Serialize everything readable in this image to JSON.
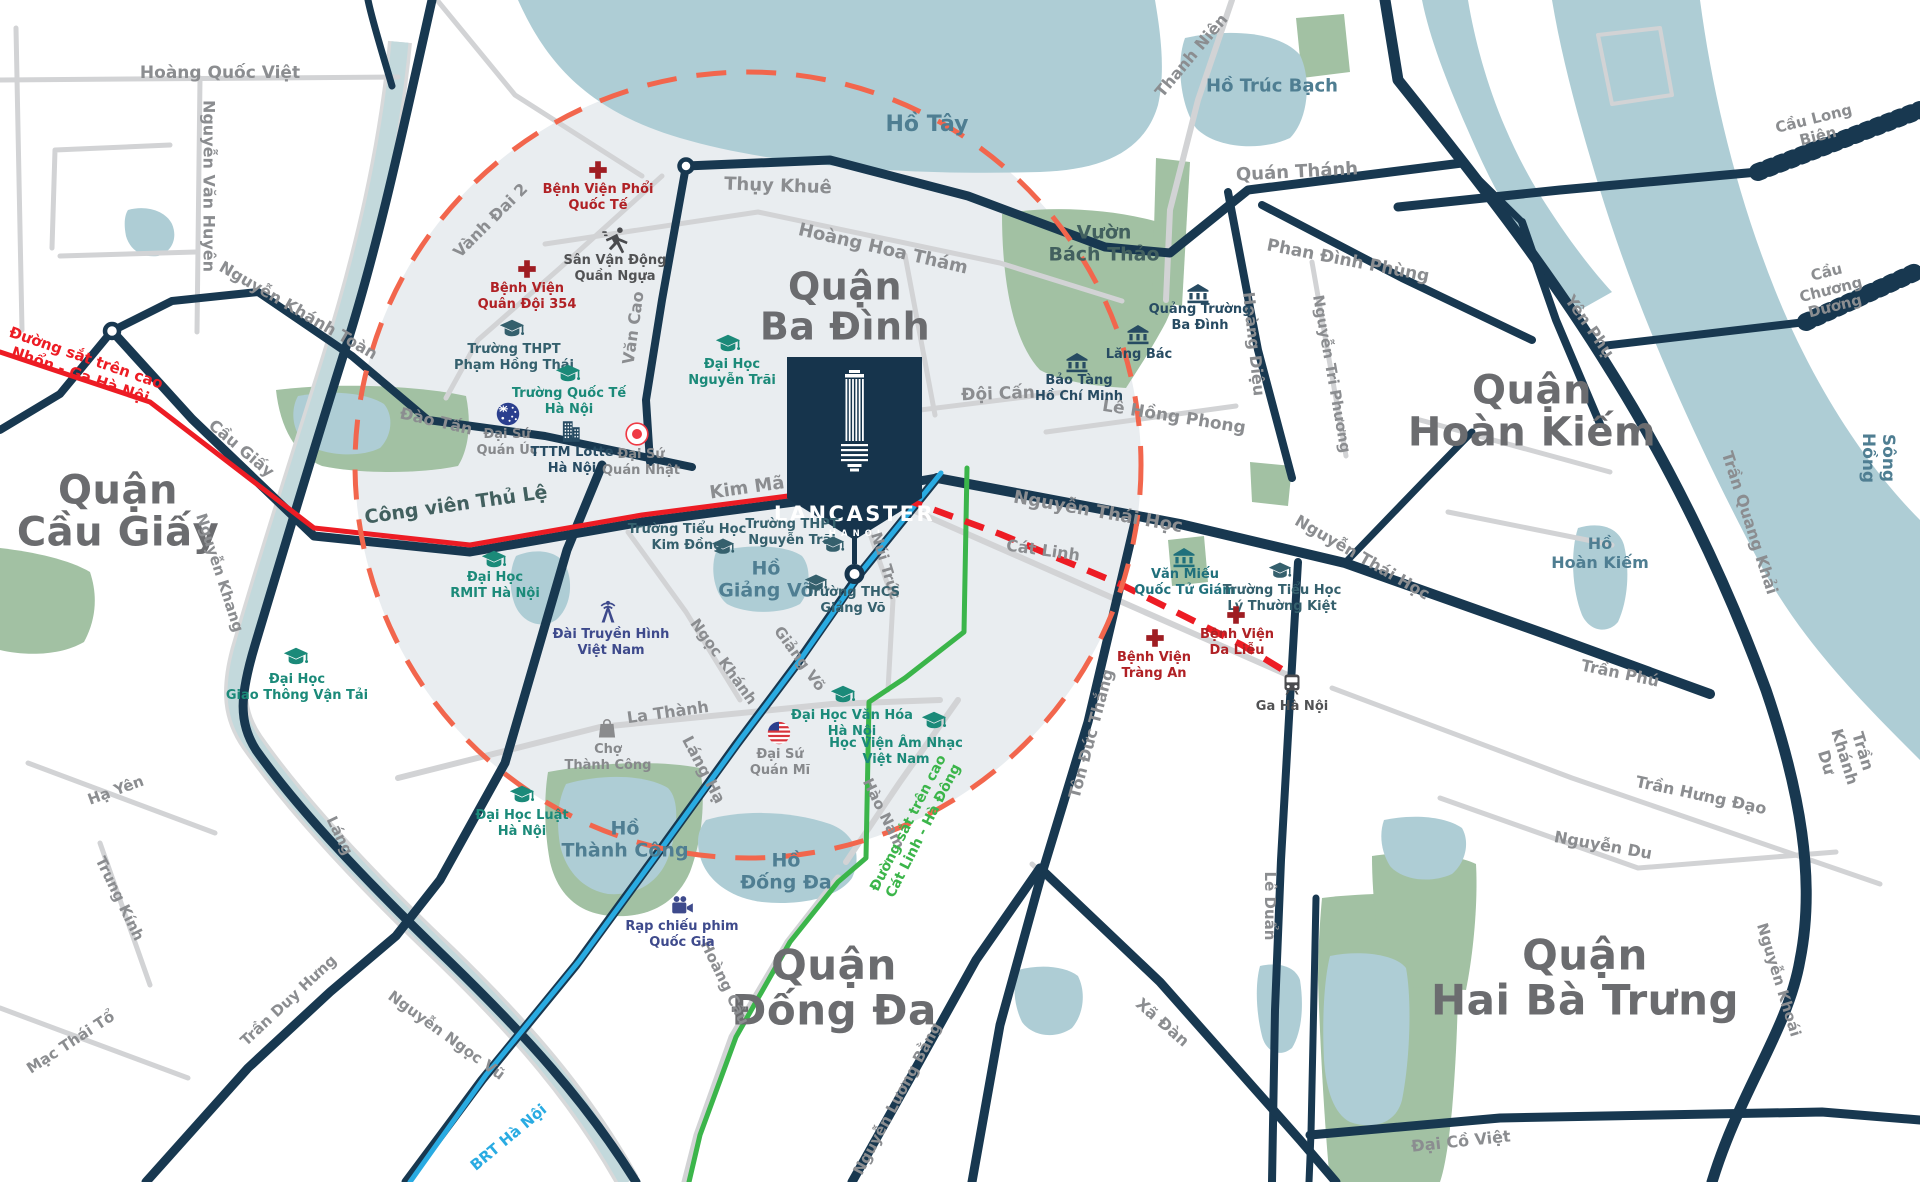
{
  "map": {
    "palette": {
      "road-navy": "#183850",
      "road-gray": "#d2d3d5",
      "water": "#aecdd5",
      "park": "#a2c1a3",
      "river": "#c3d9dc",
      "tint": "#e9edf0",
      "circle-dash": "#f2664d",
      "rail-red": "#ed1c24",
      "rail-green": "#3bb54a",
      "rail-blue": "#29abe2",
      "marker-navy": "#16344c"
    },
    "marker": {
      "brand": "LANCASTER",
      "sub": "HANOI"
    },
    "districts": [
      {
        "t": "Quận\nCầu Giấy",
        "x": 118,
        "y": 512,
        "s": 40
      },
      {
        "t": "Quận\nBa Đình",
        "x": 845,
        "y": 307,
        "s": 38
      },
      {
        "t": "Quận\nHoàn Kiếm",
        "x": 1532,
        "y": 412,
        "s": 40
      },
      {
        "t": "Quận\nĐống Đa",
        "x": 834,
        "y": 988,
        "s": 42
      },
      {
        "t": "Quận\nHai Bà Trưng",
        "x": 1585,
        "y": 978,
        "s": 42
      }
    ],
    "lakes": [
      {
        "t": "Hồ Tây",
        "x": 927,
        "y": 125,
        "s": 22,
        "rot": 0
      },
      {
        "t": "Hồ Trúc Bạch",
        "x": 1272,
        "y": 86,
        "s": 18,
        "rot": 0
      },
      {
        "t": "Hồ\nHoàn Kiếm",
        "x": 1600,
        "y": 554,
        "s": 16,
        "rot": 0
      },
      {
        "t": "Hồ\nGiảng Võ",
        "x": 766,
        "y": 580,
        "s": 19,
        "rot": 0
      },
      {
        "t": "Hồ\nThành Công",
        "x": 625,
        "y": 840,
        "s": 19,
        "rot": 0
      },
      {
        "t": "Hồ\nĐống Đa",
        "x": 786,
        "y": 872,
        "s": 19,
        "rot": 0
      },
      {
        "t": "Sông Hồng",
        "x": 1878,
        "y": 458,
        "s": 17,
        "rot": 90
      }
    ],
    "parks": [
      {
        "t": "Vườn\nBách Thảo",
        "x": 1104,
        "y": 244,
        "s": 19,
        "rot": 0
      },
      {
        "t": "Công viên Thủ Lệ",
        "x": 456,
        "y": 505,
        "s": 19,
        "rot": -8
      }
    ],
    "roads": [
      {
        "t": "Hoàng Quốc Việt",
        "x": 220,
        "y": 73,
        "rot": 0,
        "s": 17
      },
      {
        "t": "Nguyễn Văn Huyên",
        "x": 208,
        "y": 186,
        "rot": 90,
        "s": 16
      },
      {
        "t": "Nguyễn Khánh Toàn",
        "x": 298,
        "y": 311,
        "rot": 30,
        "s": 16
      },
      {
        "t": "Vành Đai 2",
        "x": 491,
        "y": 221,
        "rot": -45,
        "s": 16
      },
      {
        "t": "Thụy Khuê",
        "x": 778,
        "y": 186,
        "rot": 2,
        "s": 18
      },
      {
        "t": "Hoàng Hoa Thám",
        "x": 883,
        "y": 249,
        "rot": 13,
        "s": 18
      },
      {
        "t": "Quán Thánh",
        "x": 1297,
        "y": 172,
        "rot": -3,
        "s": 18
      },
      {
        "t": "Thanh Niên",
        "x": 1192,
        "y": 56,
        "rot": -50,
        "s": 16
      },
      {
        "t": "Phan Đình Phùng",
        "x": 1348,
        "y": 261,
        "rot": 11,
        "s": 17
      },
      {
        "t": "Yên Phụ",
        "x": 1589,
        "y": 327,
        "rot": 55,
        "s": 16
      },
      {
        "t": "Cầu Long Biên",
        "x": 1816,
        "y": 128,
        "rot": -14,
        "s": 15
      },
      {
        "t": "Cầu Chương Dương",
        "x": 1831,
        "y": 290,
        "rot": -14,
        "s": 15
      },
      {
        "t": "Trần Quang Khải",
        "x": 1749,
        "y": 523,
        "rot": 72,
        "s": 16
      },
      {
        "t": "Trần Khánh Dư",
        "x": 1844,
        "y": 757,
        "rot": 73,
        "s": 16
      },
      {
        "t": "Nguyễn Khoái",
        "x": 1778,
        "y": 980,
        "rot": 73,
        "s": 15
      },
      {
        "t": "Trần Phú",
        "x": 1620,
        "y": 674,
        "rot": 12,
        "s": 16
      },
      {
        "t": "Trần Hưng Đạo",
        "x": 1701,
        "y": 796,
        "rot": 12,
        "s": 16
      },
      {
        "t": "Nguyễn Du",
        "x": 1603,
        "y": 846,
        "rot": 10,
        "s": 16
      },
      {
        "t": "Đại Cồ Việt",
        "x": 1461,
        "y": 1142,
        "rot": -6,
        "s": 16
      },
      {
        "t": "Xã Đàn",
        "x": 1162,
        "y": 1023,
        "rot": 41,
        "s": 16
      },
      {
        "t": "Nguyễn Lương Bằng",
        "x": 898,
        "y": 1099,
        "rot": -62,
        "s": 15
      },
      {
        "t": "Tôn Đức Thắng",
        "x": 1092,
        "y": 734,
        "rot": -75,
        "s": 16
      },
      {
        "t": "Lê Duẩn",
        "x": 1269,
        "y": 906,
        "rot": 90,
        "s": 15
      },
      {
        "t": "Nguyễn Thái Học",
        "x": 1098,
        "y": 512,
        "rot": 10,
        "s": 18
      },
      {
        "t": "Nguyễn Thái Học",
        "x": 1362,
        "y": 558,
        "rot": 30,
        "s": 16
      },
      {
        "t": "Cát Linh",
        "x": 1043,
        "y": 551,
        "rot": 8,
        "s": 16
      },
      {
        "t": "Đội Cấn",
        "x": 998,
        "y": 394,
        "rot": -2,
        "s": 17
      },
      {
        "t": "Lê Hồng Phong",
        "x": 1174,
        "y": 417,
        "rot": 9,
        "s": 17
      },
      {
        "t": "Hoàng Diệu",
        "x": 1253,
        "y": 344,
        "rot": 84,
        "s": 16
      },
      {
        "t": "Nguyễn Tri Phương",
        "x": 1331,
        "y": 374,
        "rot": 80,
        "s": 15
      },
      {
        "t": "Kim Mã",
        "x": 747,
        "y": 488,
        "rot": -8,
        "s": 18
      },
      {
        "t": "Văn Cao",
        "x": 634,
        "y": 328,
        "rot": -82,
        "s": 16
      },
      {
        "t": "Đào Tấn",
        "x": 436,
        "y": 422,
        "rot": 13,
        "s": 16
      },
      {
        "t": "Cầu Giấy",
        "x": 241,
        "y": 449,
        "rot": 40,
        "s": 16
      },
      {
        "t": "Nguyễn Khang",
        "x": 219,
        "y": 573,
        "rot": 72,
        "s": 15
      },
      {
        "t": "Láng",
        "x": 339,
        "y": 836,
        "rot": 64,
        "s": 15
      },
      {
        "t": "Trần Duy Hưng",
        "x": 289,
        "y": 1001,
        "rot": -43,
        "s": 15
      },
      {
        "t": "Nguyễn Ngọc Vũ",
        "x": 446,
        "y": 1036,
        "rot": 36,
        "s": 15
      },
      {
        "t": "Mạc Thái Tổ",
        "x": 71,
        "y": 1043,
        "rot": -33,
        "s": 15
      },
      {
        "t": "Trung Kính",
        "x": 119,
        "y": 899,
        "rot": 64,
        "s": 15
      },
      {
        "t": "Hạ Yên",
        "x": 116,
        "y": 791,
        "rot": -20,
        "s": 15
      },
      {
        "t": "La Thành",
        "x": 668,
        "y": 713,
        "rot": -8,
        "s": 16
      },
      {
        "t": "Ngọc Khánh",
        "x": 723,
        "y": 662,
        "rot": 54,
        "s": 15
      },
      {
        "t": "Giảng Võ",
        "x": 799,
        "y": 659,
        "rot": 54,
        "s": 15
      },
      {
        "t": "Núi Trúc",
        "x": 885,
        "y": 566,
        "rot": 73,
        "s": 15
      },
      {
        "t": "Hào Nam",
        "x": 883,
        "y": 814,
        "rot": 64,
        "s": 15
      },
      {
        "t": "Hoàng Cầu",
        "x": 724,
        "y": 983,
        "rot": 64,
        "s": 15
      },
      {
        "t": "Láng Hạ",
        "x": 703,
        "y": 770,
        "rot": 62,
        "s": 16
      }
    ],
    "rails": [
      {
        "t": "Đường sắt trên cao\nNhổn - Ga Hà Nội",
        "x": 83,
        "y": 367,
        "rot": 19,
        "s": 15,
        "c": "red"
      },
      {
        "t": "Đường sắt trên cao\nCát Linh - Hà Đông",
        "x": 916,
        "y": 827,
        "rot": -63,
        "s": 14,
        "c": "green"
      },
      {
        "t": "BRT Hà Nội",
        "x": 509,
        "y": 1138,
        "rot": -40,
        "s": 15,
        "c": "blue"
      }
    ],
    "pois": [
      {
        "name": "benh-vien-phoi-quoc-te",
        "icon": "cross",
        "cls": "red",
        "ix": 598,
        "iy": 170,
        "iw": 20,
        "label": "Bệnh Viện Phổi\nQuốc Tế",
        "lx": 598,
        "ly": 198
      },
      {
        "name": "san-van-dong-quan-ngua",
        "icon": "runner",
        "cls": "darkgray",
        "ix": 615,
        "iy": 240,
        "iw": 28,
        "label": "Sân Vận Động\nQuần Ngựa",
        "lx": 615,
        "ly": 269
      },
      {
        "name": "benh-vien-quan-doi-354",
        "icon": "cross",
        "cls": "red",
        "ix": 527,
        "iy": 269,
        "iw": 20,
        "label": "Bệnh Viện\nQuân Đội 354",
        "lx": 527,
        "ly": 297
      },
      {
        "name": "truong-thpt-pham-hong-thai",
        "icon": "school",
        "cls": "darkteal",
        "ix": 512,
        "iy": 330,
        "iw": 26,
        "label": "Trường THPT\nPhạm Hồng Thái",
        "lx": 514,
        "ly": 358
      },
      {
        "name": "truong-quoc-te-ha-noi",
        "icon": "school",
        "cls": "teal",
        "ix": 568,
        "iy": 375,
        "iw": 26,
        "label": "Trường Quốc Tế\nHà Nội",
        "lx": 569,
        "ly": 402
      },
      {
        "name": "dai-su-quan-uc",
        "icon": "flagau",
        "cls": "gray",
        "ix": 508,
        "iy": 414,
        "iw": 25,
        "label": "Đại Sứ\nQuán Úc",
        "lx": 507,
        "ly": 443
      },
      {
        "name": "tttm-lotte-ha-noi",
        "icon": "building",
        "cls": "navy",
        "ix": 571,
        "iy": 431,
        "iw": 26,
        "label": "TTTM Lotte\nHà Nội",
        "lx": 572,
        "ly": 461
      },
      {
        "name": "dai-su-quan-nhat",
        "icon": "flagjp",
        "cls": "gray",
        "ix": 637,
        "iy": 434,
        "iw": 25,
        "label": "Đại Sứ\nQuán Nhật",
        "lx": 641,
        "ly": 463
      },
      {
        "name": "dai-hoc-nguyen-trai",
        "icon": "school",
        "cls": "teal",
        "ix": 728,
        "iy": 345,
        "iw": 26,
        "label": "Đại Học\nNguyễn Trãi",
        "lx": 732,
        "ly": 373
      },
      {
        "name": "quang-truong-ba-dinh",
        "icon": "museum",
        "cls": "navy",
        "ix": 1198,
        "iy": 293,
        "iw": 24,
        "label": "Quảng Trường\nBa Đình",
        "lx": 1200,
        "ly": 318
      },
      {
        "name": "lang-bac",
        "icon": "museum",
        "cls": "navy",
        "ix": 1138,
        "iy": 334,
        "iw": 24,
        "label": "Lăng Bác",
        "lx": 1139,
        "ly": 355
      },
      {
        "name": "bao-tang-ho-chi-minh",
        "icon": "museum",
        "cls": "navy",
        "ix": 1077,
        "iy": 362,
        "iw": 24,
        "label": "Bảo Tàng\nHồ Chí Minh",
        "lx": 1079,
        "ly": 389
      },
      {
        "name": "truong-tieu-hoc-kim-dong",
        "icon": "school",
        "cls": "darkteal",
        "ix": 723,
        "iy": 548,
        "iw": 24,
        "label": "Trường Tiểu Học\nKim Đồng",
        "lx": 687,
        "ly": 538
      },
      {
        "name": "truong-thpt-nguyen-trai",
        "icon": "school",
        "cls": "darkteal",
        "ix": 833,
        "iy": 546,
        "iw": 24,
        "label": "Trường THPT\nNguyễn Trãi",
        "lx": 792,
        "ly": 533
      },
      {
        "name": "truong-thcs-giang-vo",
        "icon": "school",
        "cls": "darkteal",
        "ix": 816,
        "iy": 584,
        "iw": 24,
        "label": "Trường THCS\nGiảng Võ",
        "lx": 853,
        "ly": 601
      },
      {
        "name": "dai-hoc-rmit-ha-noi",
        "icon": "school",
        "cls": "teal",
        "ix": 494,
        "iy": 561,
        "iw": 26,
        "label": "Đại Học\nRMIT Hà Nội",
        "lx": 495,
        "ly": 586
      },
      {
        "name": "dai-truyen-hinh-viet-nam",
        "icon": "antenna",
        "cls": "indigo",
        "ix": 608,
        "iy": 612,
        "iw": 28,
        "label": "Đài Truyền Hình\nViệt Nam",
        "lx": 611,
        "ly": 643
      },
      {
        "name": "dai-hoc-giao-thong-van-tai",
        "icon": "school",
        "cls": "teal",
        "ix": 296,
        "iy": 658,
        "iw": 26,
        "label": "Đại Học\nGiao Thông Vận Tải",
        "lx": 297,
        "ly": 688
      },
      {
        "name": "cho-thanh-cong",
        "icon": "bag",
        "cls": "gray",
        "ix": 607,
        "iy": 728,
        "iw": 24,
        "label": "Chợ\nThành Công",
        "lx": 608,
        "ly": 758
      },
      {
        "name": "dai-su-quan-mi",
        "icon": "flagus",
        "cls": "gray",
        "ix": 779,
        "iy": 733,
        "iw": 25,
        "label": "Đại Sứ\nQuán Mĩ",
        "lx": 780,
        "ly": 763
      },
      {
        "name": "dai-hoc-luat-ha-noi",
        "icon": "school",
        "cls": "teal",
        "ix": 522,
        "iy": 796,
        "iw": 26,
        "label": "Đại Học Luật\nHà Nội",
        "lx": 522,
        "ly": 824
      },
      {
        "name": "rap-chieu-phim-quoc-gia",
        "icon": "cinema",
        "cls": "indigo",
        "ix": 682,
        "iy": 906,
        "iw": 26,
        "label": "Rạp chiếu phim\nQuốc Gia",
        "lx": 682,
        "ly": 935
      },
      {
        "name": "dai-hoc-van-hoa-ha-noi",
        "icon": "school",
        "cls": "teal",
        "ix": 843,
        "iy": 696,
        "iw": 26,
        "label": "Đại Học Văn Hóa\nHà Nội",
        "lx": 852,
        "ly": 724
      },
      {
        "name": "hoc-vien-am-nhac-viet-nam",
        "icon": "school",
        "cls": "teal",
        "ix": 934,
        "iy": 722,
        "iw": 26,
        "label": "Học Viện Âm Nhạc\nViệt Nam",
        "lx": 896,
        "ly": 752
      },
      {
        "name": "van-mieu-quoc-tu-giam",
        "icon": "museum",
        "cls": "tealdark",
        "ix": 1184,
        "iy": 557,
        "iw": 24,
        "label": "Văn Miếu\nQuốc Tử Giám",
        "lx": 1185,
        "ly": 583
      },
      {
        "name": "truong-tieu-hoc-ly-thuong-kiet",
        "icon": "school",
        "cls": "darkteal",
        "ix": 1280,
        "iy": 572,
        "iw": 24,
        "label": "Trường Tiểu Học\nLý Thường Kiệt",
        "lx": 1282,
        "ly": 599
      },
      {
        "name": "benh-vien-trang-an",
        "icon": "cross",
        "cls": "red",
        "ix": 1155,
        "iy": 638,
        "iw": 20,
        "label": "Bệnh Viện\nTràng An",
        "lx": 1154,
        "ly": 666
      },
      {
        "name": "benh-vien-da-lieu",
        "icon": "cross",
        "cls": "red",
        "ix": 1236,
        "iy": 615,
        "iw": 20,
        "label": "Bệnh Viện\nDa Liễu",
        "lx": 1237,
        "ly": 643
      },
      {
        "name": "ga-ha-noi",
        "icon": "train",
        "cls": "darkgray",
        "ix": 1292,
        "iy": 684,
        "iw": 24,
        "label": "Ga Hà Nội",
        "lx": 1292,
        "ly": 707
      }
    ]
  }
}
